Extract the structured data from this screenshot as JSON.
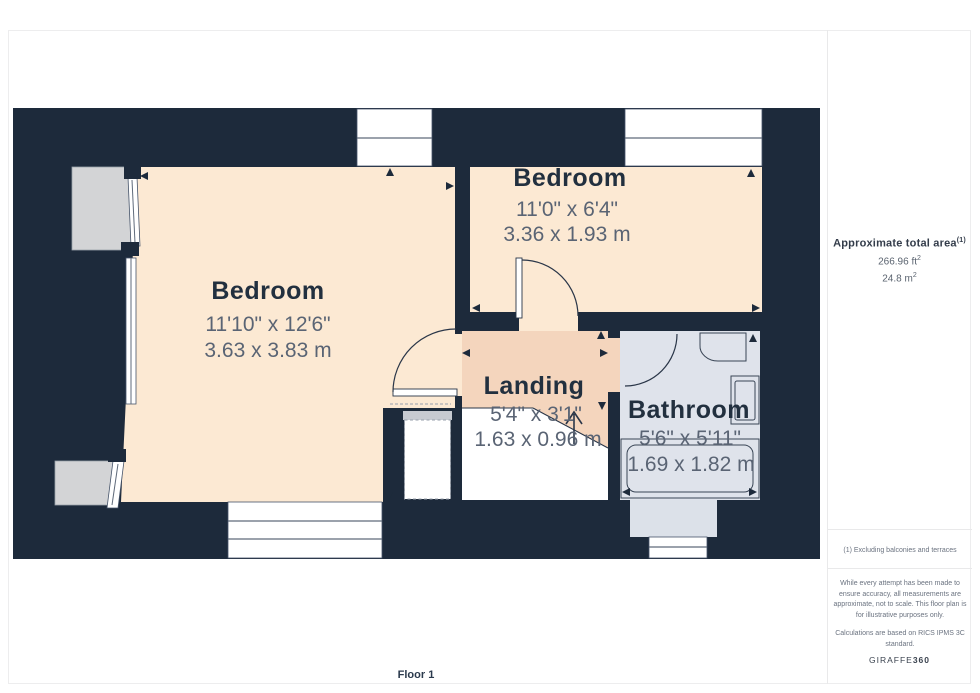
{
  "floorplan": {
    "floor_label": "Floor 1",
    "rooms": [
      {
        "name": "Bedroom",
        "imperial": "11'10\" x 12'6\"",
        "metric": "3.63 x 3.83 m"
      },
      {
        "name": "Bedroom",
        "imperial": "11'0\" x 6'4\"",
        "metric": "3.36 x 1.93 m"
      },
      {
        "name": "Landing",
        "imperial": "5'4\" x 3'1\"",
        "metric": "1.63 x 0.96 m"
      },
      {
        "name": "Bathroom",
        "imperial": "5'6\" x 5'11\"",
        "metric": "1.69 x 1.82 m"
      }
    ],
    "colors": {
      "wall": "#1d2a3b",
      "bedroom_floor": "#fce9d3",
      "landing_floor": "#f4d5bd",
      "bathroom_floor": "#dfe3eb",
      "chimney": "#d3d4d6"
    }
  },
  "sidebar": {
    "total_area_label": "Approximate total area",
    "footnote_marker": "(1)",
    "area_ft_value": "266.96 ft",
    "area_m_value": "24.8 m",
    "superscript_two": "2",
    "footnote": "(1) Excluding balconies and terraces",
    "disclaimer": "While every attempt has been made to ensure accuracy, all measurements are approximate, not to scale. This floor plan is for illustrative purposes only.",
    "standard": "Calculations are based on RICS IPMS 3C standard.",
    "brand": "GIRAFFE",
    "brand_suffix": "360"
  }
}
